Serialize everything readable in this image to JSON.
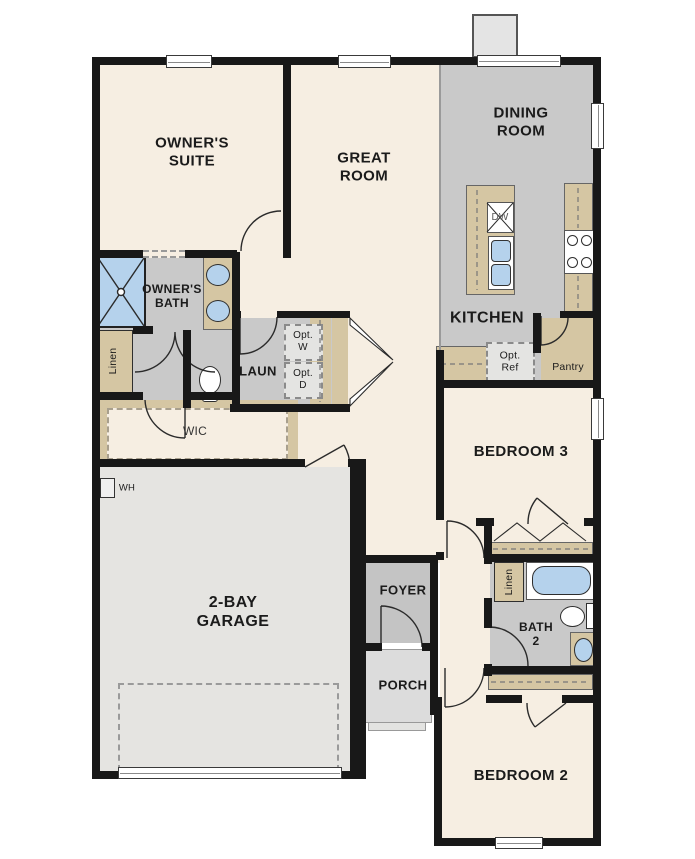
{
  "colors": {
    "wall": "#181818",
    "room_cream": "#f6eee2",
    "room_gray": "#c9c9c9",
    "garage_gray": "#e5e4e1",
    "porch_gray": "#dcdcdc",
    "counter_tan": "#d5c6a3",
    "fixture_blue": "#b5d2ec",
    "chimney_gray": "#e4e4e4"
  },
  "rooms": {
    "owners_suite": {
      "label": "OWNER'S\nSUITE"
    },
    "great_room": {
      "label": "GREAT\nROOM"
    },
    "dining_room": {
      "label": "DINING\nROOM"
    },
    "kitchen": {
      "label": "KITCHEN"
    },
    "owners_bath": {
      "label": "OWNER'S\nBATH"
    },
    "laundry": {
      "label": "LAUN"
    },
    "wic": {
      "label": "WIC"
    },
    "garage": {
      "label": "2-BAY\nGARAGE"
    },
    "bedroom3": {
      "label": "BEDROOM 3"
    },
    "foyer": {
      "label": "FOYER"
    },
    "porch": {
      "label": "PORCH"
    },
    "bath2": {
      "label": "BATH\n2"
    },
    "bedroom2": {
      "label": "BEDROOM 2"
    },
    "pantry": {
      "label": "Pantry"
    }
  },
  "closets": {
    "linen_owners": {
      "label": "Linen"
    },
    "linen_hall": {
      "label": "Linen"
    }
  },
  "appliances": {
    "dishwasher": {
      "label": "DW"
    },
    "water_heater": {
      "label": "WH"
    },
    "optional_washer": {
      "label": "Opt.\nW"
    },
    "optional_dryer": {
      "label": "Opt.\nD"
    },
    "optional_refrigerator": {
      "label": "Opt.\nRef"
    }
  }
}
